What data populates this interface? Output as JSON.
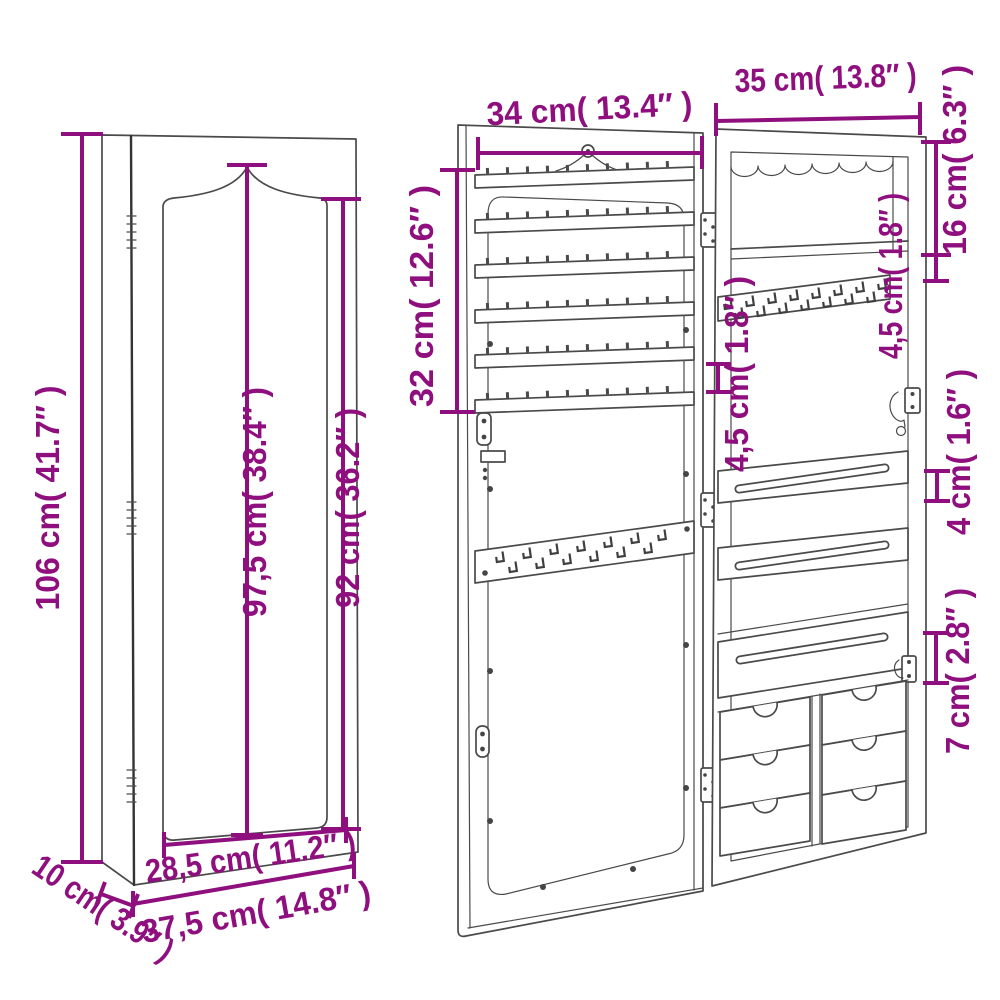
{
  "figure": {
    "type": "product-dimension-diagram",
    "subject": "wall-mounted mirror jewellery cabinet",
    "accent_color": "#8e0f7d",
    "line_color": "#4a4a4a",
    "background_color": "#ffffff"
  },
  "views": {
    "closed": {
      "dimensions": {
        "overall_height": {
          "label": "106 cm( 41.7″ )",
          "cm": "106",
          "in": "41.7"
        },
        "mirror_height": {
          "label": "97,5 cm( 38.4″ )",
          "cm": "97,5",
          "in": "38.4"
        },
        "door_height": {
          "label": "92 cm( 36.2″ )",
          "cm": "92",
          "in": "36.2"
        },
        "mirror_width": {
          "label": "28,5 cm( 11.2″ )",
          "cm": "28,5",
          "in": "11.2"
        },
        "overall_width": {
          "label": "37,5 cm( 14.8″ )",
          "cm": "37,5",
          "in": "14.8"
        },
        "depth": {
          "label": "10 cm( 3.9″ )",
          "cm": "10",
          "in": "3.9"
        }
      }
    },
    "open": {
      "dimensions": {
        "door_interior_width": {
          "label": "34 cm( 13.4″ )",
          "cm": "34",
          "in": "13.4"
        },
        "cabinet_interior_width": {
          "label": "35 cm( 13.8″ )",
          "cm": "35",
          "in": "13.8"
        },
        "earring_rack_height": {
          "label": "32 cm( 12.6″ )",
          "cm": "32",
          "in": "12.6"
        },
        "top_compartment_height": {
          "label": "16 cm( 6.3″ )",
          "cm": "16",
          "in": "6.3"
        },
        "shelf_to_hooks_gap": {
          "label": "4,5 cm( 1.8″ )",
          "cm": "4,5",
          "in": "1.8"
        },
        "earring_rail_gap": {
          "label": "4,5 cm( 1.8″ )",
          "cm": "4,5",
          "in": "1.8"
        },
        "necklace_shelf_height": {
          "label": "4 cm( 1.6″ )",
          "cm": "4",
          "in": "1.6"
        },
        "bottom_tray_height": {
          "label": "7 cm( 2.8″ )",
          "cm": "7",
          "in": "2.8"
        }
      }
    }
  }
}
